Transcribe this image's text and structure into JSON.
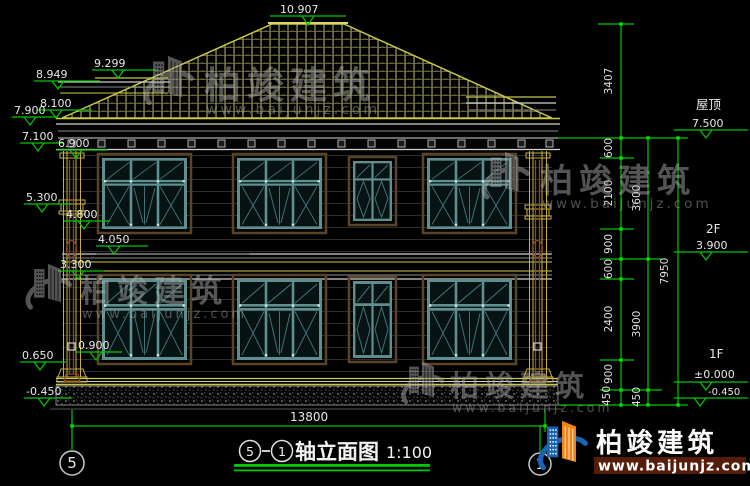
{
  "title": {
    "axis_left": "5",
    "axis_right": "1",
    "text": "轴立面图",
    "scale": "1:100"
  },
  "axes": {
    "left": "5",
    "right": "1"
  },
  "dims": {
    "top": "10.907",
    "left": [
      "9.299",
      "8.949",
      "8.100",
      "7.900",
      "7.100",
      "6.900",
      "5.300",
      "4.800",
      "4.050",
      "3.300",
      "0.900",
      "0.650",
      "-0.450"
    ],
    "right": {
      "roof_name": "屋顶",
      "roof": "7.500",
      "f2_name": "2F",
      "f2": "3.900",
      "f1_name": "1F",
      "f1": "±0.000",
      "base": "-0.450"
    },
    "col1": [
      "3407",
      "600",
      "2100",
      "900",
      "600",
      "2400",
      "900",
      "450"
    ],
    "col2": [
      "3600",
      "3900",
      "450"
    ],
    "col3": [
      "7950"
    ],
    "width": "13800"
  },
  "watermark": {
    "brand": "柏竣建筑",
    "url": "www.baijunjz.com"
  },
  "logo": {
    "brand": "柏竣建筑",
    "url": "www.baijunjz.com"
  },
  "colors": {
    "background": "#000000",
    "dim_green": "#00c800",
    "roof_yellow": "#c8c84a",
    "window_teal": "#5d8f8f",
    "window_trim": "#5a4426",
    "downspout": "#8a4a22",
    "logo_blue": "#1b63b5",
    "logo_orange": "#f08418"
  }
}
